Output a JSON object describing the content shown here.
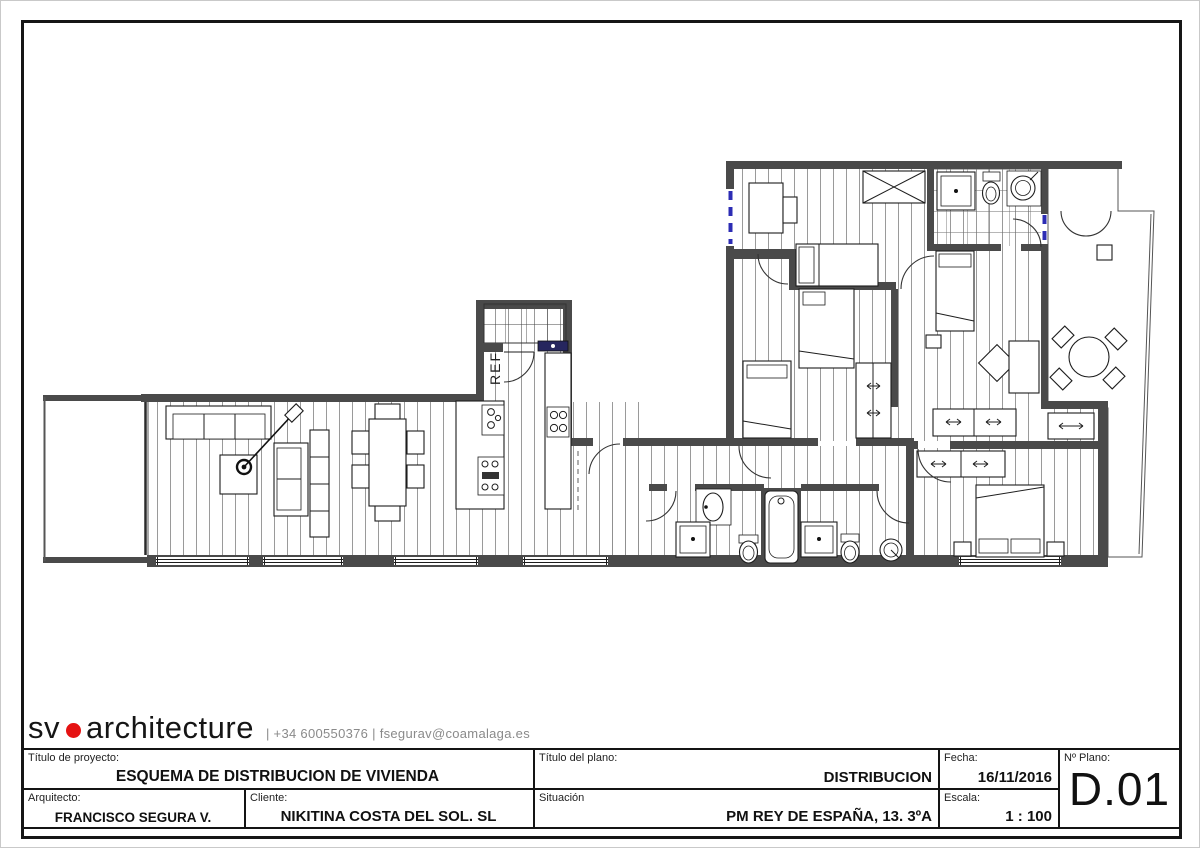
{
  "logo": {
    "brand_sv": "sv",
    "brand_rest": "architecture",
    "contact": "|  +34 600550376  |  fsegurav@coamalaga.es"
  },
  "title_block": {
    "project": {
      "label": "Título de proyecto:",
      "value": "ESQUEMA DE DISTRIBUCION DE VIVIENDA"
    },
    "architect": {
      "label": "Arquitecto:",
      "value": "FRANCISCO SEGURA V."
    },
    "client": {
      "label": "Cliente:",
      "value": "NIKITINA COSTA DEL SOL. SL"
    },
    "plan_title": {
      "label": "Título del plano:",
      "value": "DISTRIBUCION"
    },
    "situation": {
      "label": "Situación",
      "value": "PM REY DE ESPAÑA, 13. 3ºA"
    },
    "date": {
      "label": "Fecha:",
      "value": "16/11/2016"
    },
    "scale": {
      "label": "Escala:",
      "value": "1 : 100"
    },
    "plan_number": {
      "label": "Nº Plano:",
      "value": "D.01"
    }
  },
  "plan": {
    "fridge_label": "REF"
  },
  "colors": {
    "wall": "#4a4a4a",
    "line": "#1d1d1d",
    "window_blue": "#2c2cb4",
    "sink_navy": "#26265e",
    "logo_red": "#e51212"
  }
}
